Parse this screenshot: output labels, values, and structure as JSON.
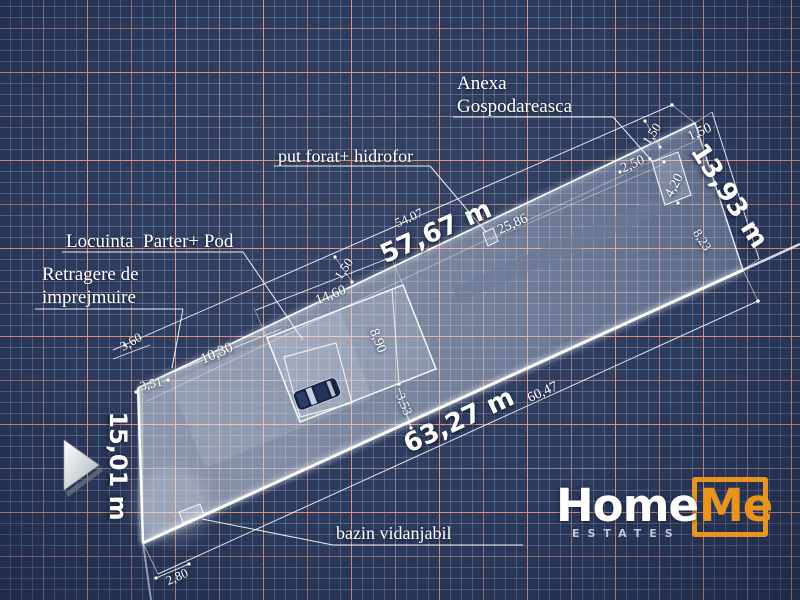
{
  "labels": {
    "anexa_line1": "Anexa",
    "anexa_line2": "Gospodareasca",
    "put_forat": "put forat+ hidrofor",
    "locuinta": "Locuinta  Parter+ Pod",
    "retragere_line1": "Retragere de",
    "retragere_line2": "imprejmuire",
    "bazin": "bazin vidanjabil"
  },
  "dimensions": {
    "side_top_total": "57,67 m",
    "side_top_alt": "54.07",
    "side_bottom_total": "63,27 m",
    "side_bottom_alt": "60,47",
    "side_right_total": "13,93 m",
    "side_left_total": "15,01 m",
    "well_to_annex": "25,86",
    "setback_front": "1,50",
    "setback_annex": "1,50",
    "annex_edge": "1,50",
    "annex_width": "2,50",
    "annex_length": "4,20",
    "annex_to_corner": "8,23",
    "house_length": "14,60",
    "house_width": "8,90",
    "house_front": "10,30",
    "corner_left_a": "3,60",
    "corner_left_b": "3,51",
    "house_to_road": "3,53",
    "road_offset": "2,80"
  },
  "logo": {
    "home": "Home",
    "me": "Me",
    "sub": "ESTATES",
    "accent_color": "#E8941F"
  },
  "colors": {
    "background": "#2C3A5D",
    "grid_minor": "#B0BED8",
    "grid_major": "#E79476",
    "parcel_fill": "#DCE4F2",
    "draw_line": "#FFFFFF",
    "logo_orange": "#E8941F"
  }
}
